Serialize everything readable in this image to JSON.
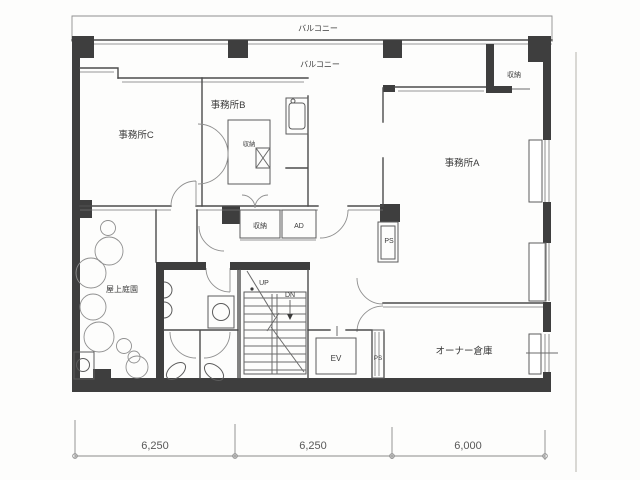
{
  "plan": {
    "balconies": [
      "バルコニー",
      "バルコニー"
    ],
    "rooms": {
      "office_a": "事務所A",
      "office_b": "事務所B",
      "office_c": "事務所C",
      "roof_garden": "屋上庭園",
      "owner_warehouse": "オーナー倉庫"
    },
    "closets": {
      "top_right": "収納",
      "office_b": "収納",
      "corridor": "収納"
    },
    "shafts": {
      "ad": "AD",
      "ps_mid": "PS",
      "ps_lower": "PS",
      "elevator": "EV"
    },
    "stairs": {
      "up": "UP",
      "down": "DN"
    },
    "dimensions": [
      "6,250",
      "6,250",
      "6,000"
    ],
    "colors": {
      "wall": "#3e3e3e",
      "line": "#4c4c4c",
      "text": "#3a3a3a",
      "paper": "#fdfdfc"
    }
  }
}
